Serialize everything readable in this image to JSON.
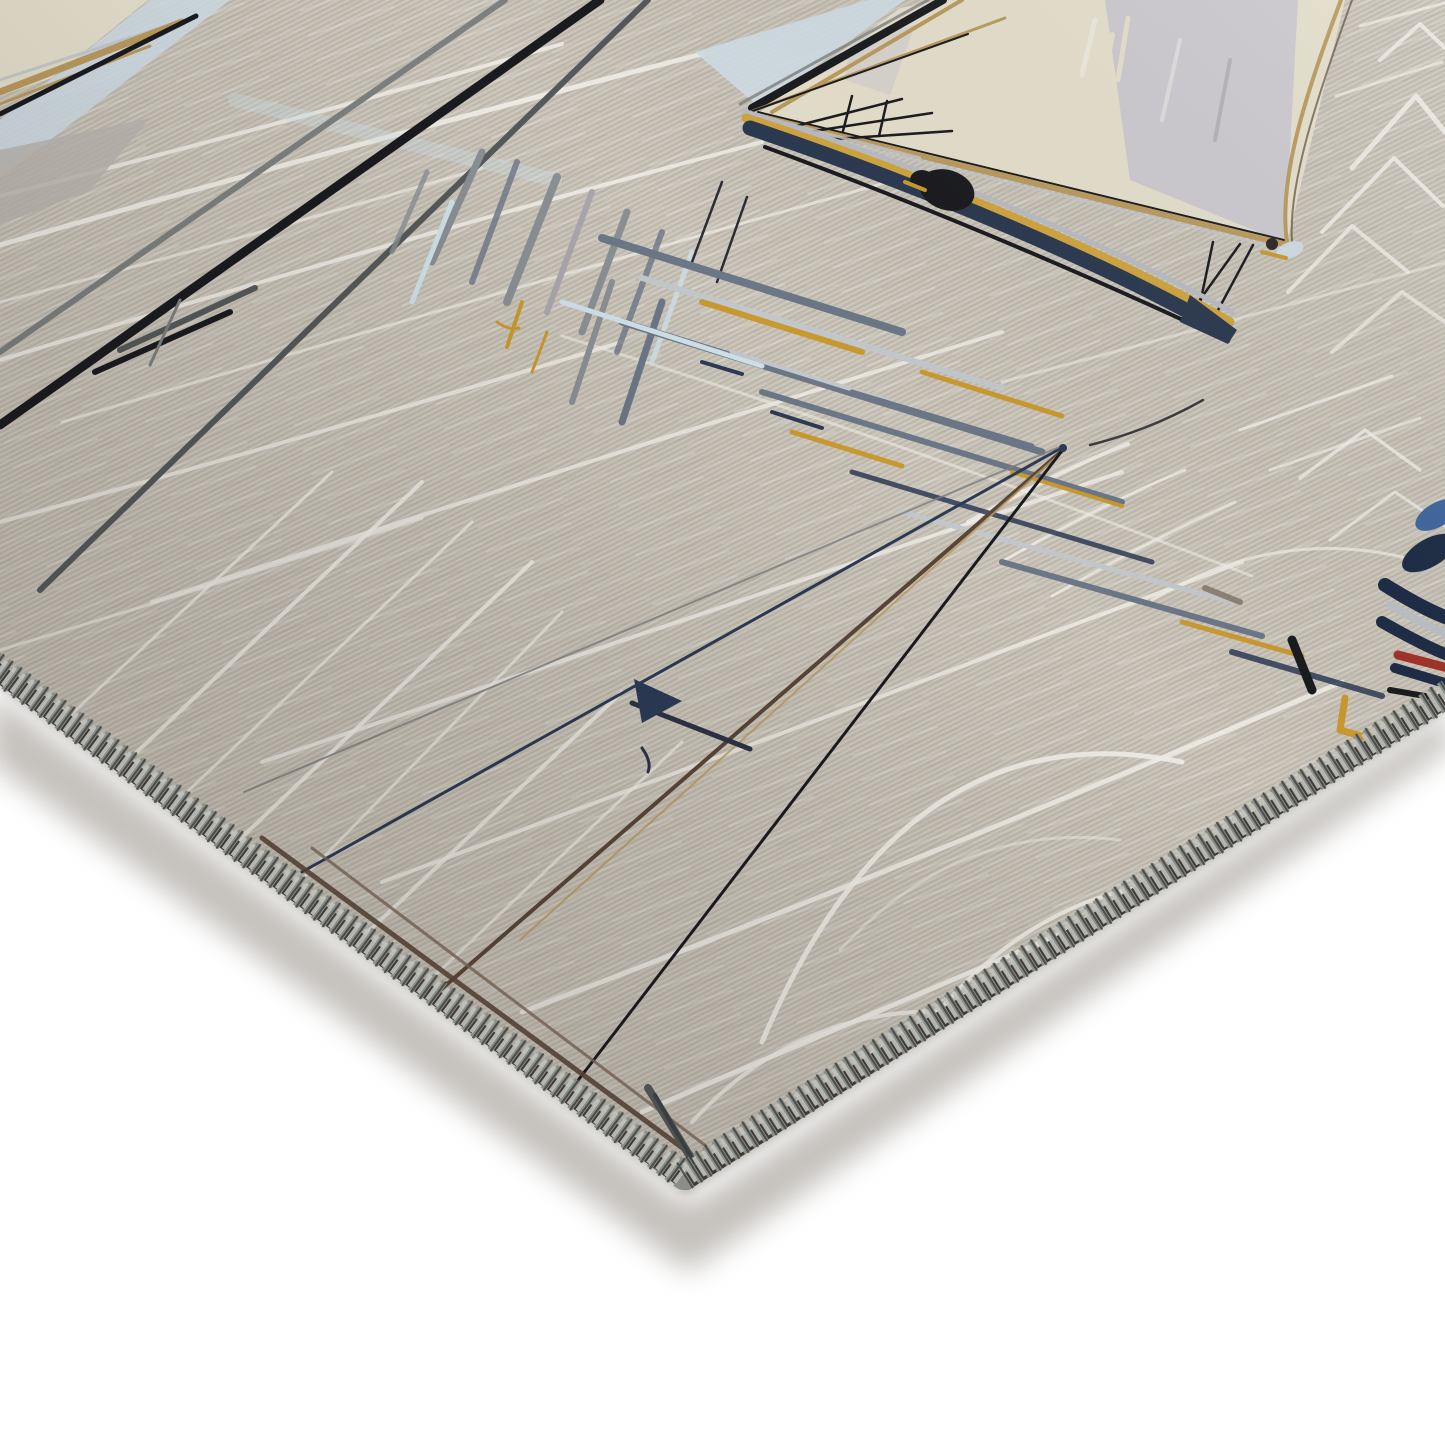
{
  "scene": {
    "alt": "Corner detail of a beige nautical area rug, rotated diagonally on a white background. The flat-woven fabric is printed with a hand-sketched harbor scene: a yellow-hulled sailboat with cream and lavender sails and a figure aboard, tall dark mast lines, thin rigging lines of a second sketched sailboat, scribbled white water lines and arcs, watery gray-blue and gold reflections, and the navy hull of another boat at the right edge. The cut edges are finished with gray overlock serge stitching, and a soft shadow falls under the corner.",
    "subject": "sailboat-print rug corner",
    "style": "product photo, hand-drawn nautical print",
    "elements": [
      "rug-fabric",
      "water-lines",
      "mast-lines",
      "main-sailboat",
      "sailboat-reflection",
      "sketch-sailboat",
      "right-edge-boat",
      "stern-topleft-boat",
      "serged-edge-stitching",
      "rug-underside-rim",
      "drop-shadow",
      "white-background"
    ]
  },
  "palette": {
    "page_bg": "#ffffff",
    "fabric": "#c4beb2",
    "fabric_light": "#cfc9bd",
    "print_white": "#f0eee7",
    "ink_black": "#1a1b1f",
    "ink_dgray": "#55595a",
    "ink_gray": "#7c807e",
    "ink_navy": "#2c3a55",
    "ink_brown": "#5a4638",
    "tan": "#b99a5e",
    "sail_cream": "#e4decb",
    "sail_lavender": "#c9c7ce",
    "sail_blue": "#cfdde6",
    "grey_lavender": "#b9b4ae",
    "hull_gold": "#cfa43e",
    "hull_navy": "#2b3950",
    "hull_silver": "#b8bcc2",
    "refl_slate": "#6b7687",
    "refl_silver": "#c2c7cc",
    "refl_gold": "#c8992f",
    "refl_blue": "#cfe0e8",
    "refl_gray": "#8a8f94",
    "refl_lavender": "#a9a5ad",
    "boat3_navy": "#1d2b45",
    "boat3_red": "#a33226",
    "boat3_blue": "#3f669c",
    "accent_orange": "#b5761f",
    "stitch_light": "#c0c2bd",
    "stitch_mid": "#8a8d88",
    "stitch_dark": "#3a3d3a",
    "rim": "#3f3a33",
    "shadow": "#8b847c"
  }
}
